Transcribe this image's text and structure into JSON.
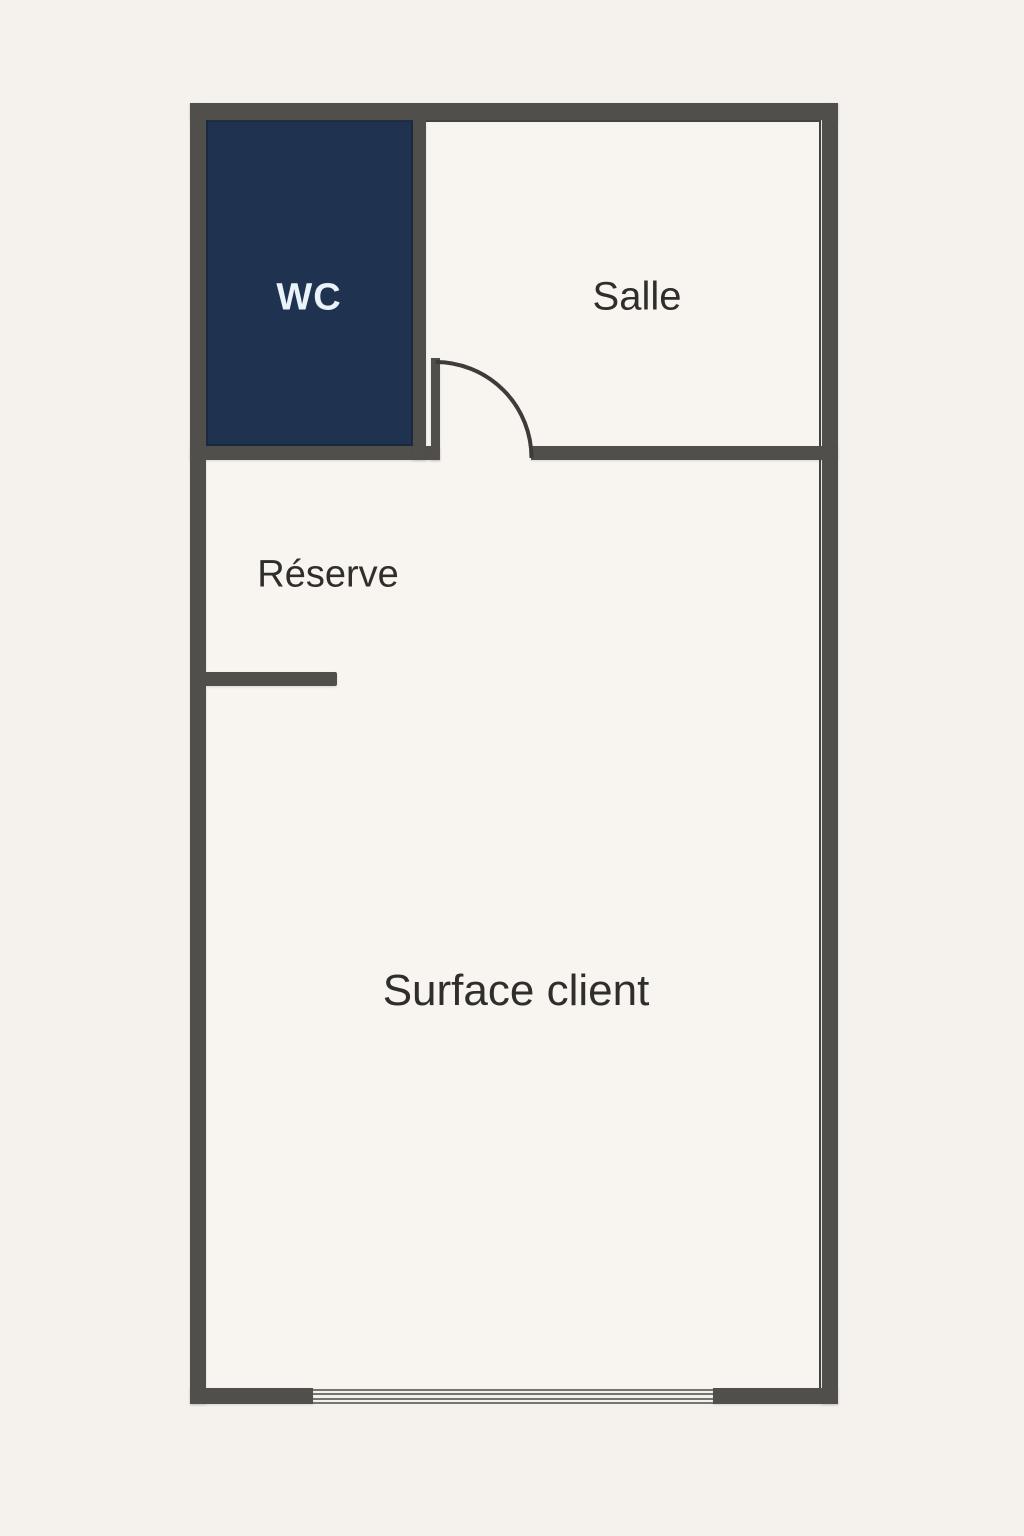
{
  "plan": {
    "rooms": {
      "wc": {
        "label": "WC"
      },
      "salle": {
        "label": "Salle"
      },
      "reserve": {
        "label": "Réserve"
      },
      "surface_client": {
        "label": "Surface client"
      }
    },
    "colors": {
      "background": "#f5f1ed",
      "room_interior": "#f8f4ef",
      "wall": "#504f4b",
      "wall_thin_line": "#44433e",
      "door_arc": "#3d3c38",
      "window_line": "#75746f",
      "wc_fill": "#1f3350",
      "wc_border": "#1a2940",
      "wc_text": "#eaf2fa",
      "label_text": "#2f2e2b"
    }
  }
}
